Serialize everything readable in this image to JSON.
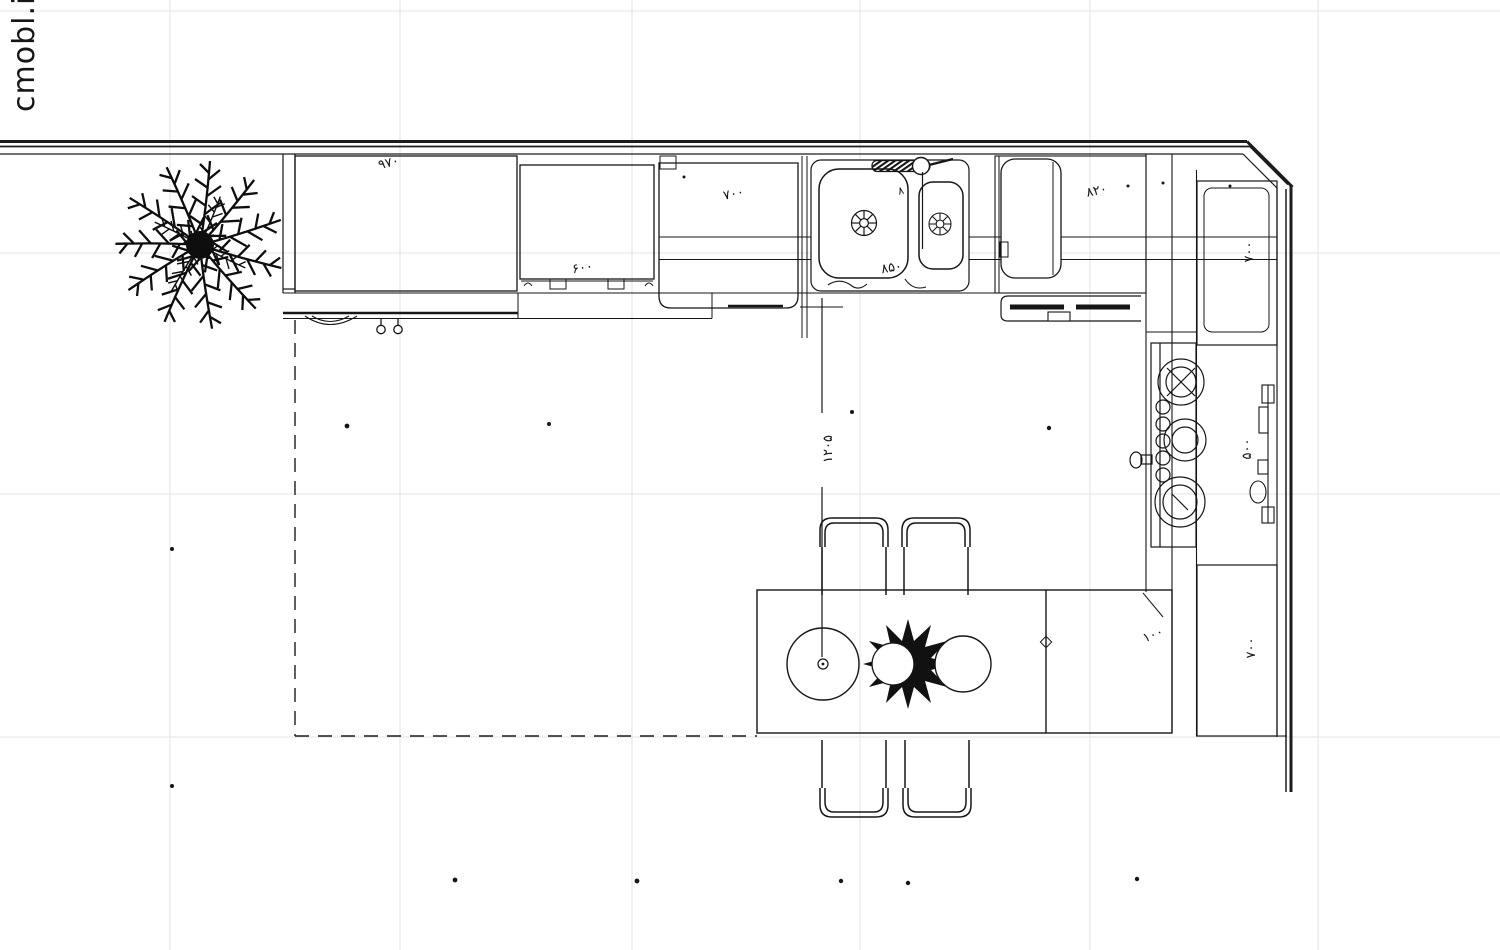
{
  "watermark": {
    "text": "cmobl.ir",
    "color": "#6f6ff0"
  },
  "colors": {
    "ink": "#161616",
    "grid": "#e3e3e7",
    "background": "#ffffff"
  },
  "dimension_labels": {
    "top_cabinet_970": "۹۷۰",
    "cabinet_600": "۶۰۰",
    "cabinet_700": "۷۰۰",
    "sink_8": "۸",
    "sink_850": "۸۵۰",
    "cabinet_820": "۸۲۰",
    "clearance_1205": "۱۲۰۵",
    "right_upper_700": "۷۰۰",
    "right_middle_500": "۵۰۰",
    "right_lower_700": "۷۰۰",
    "table_offset_100": "۱۰۰"
  }
}
